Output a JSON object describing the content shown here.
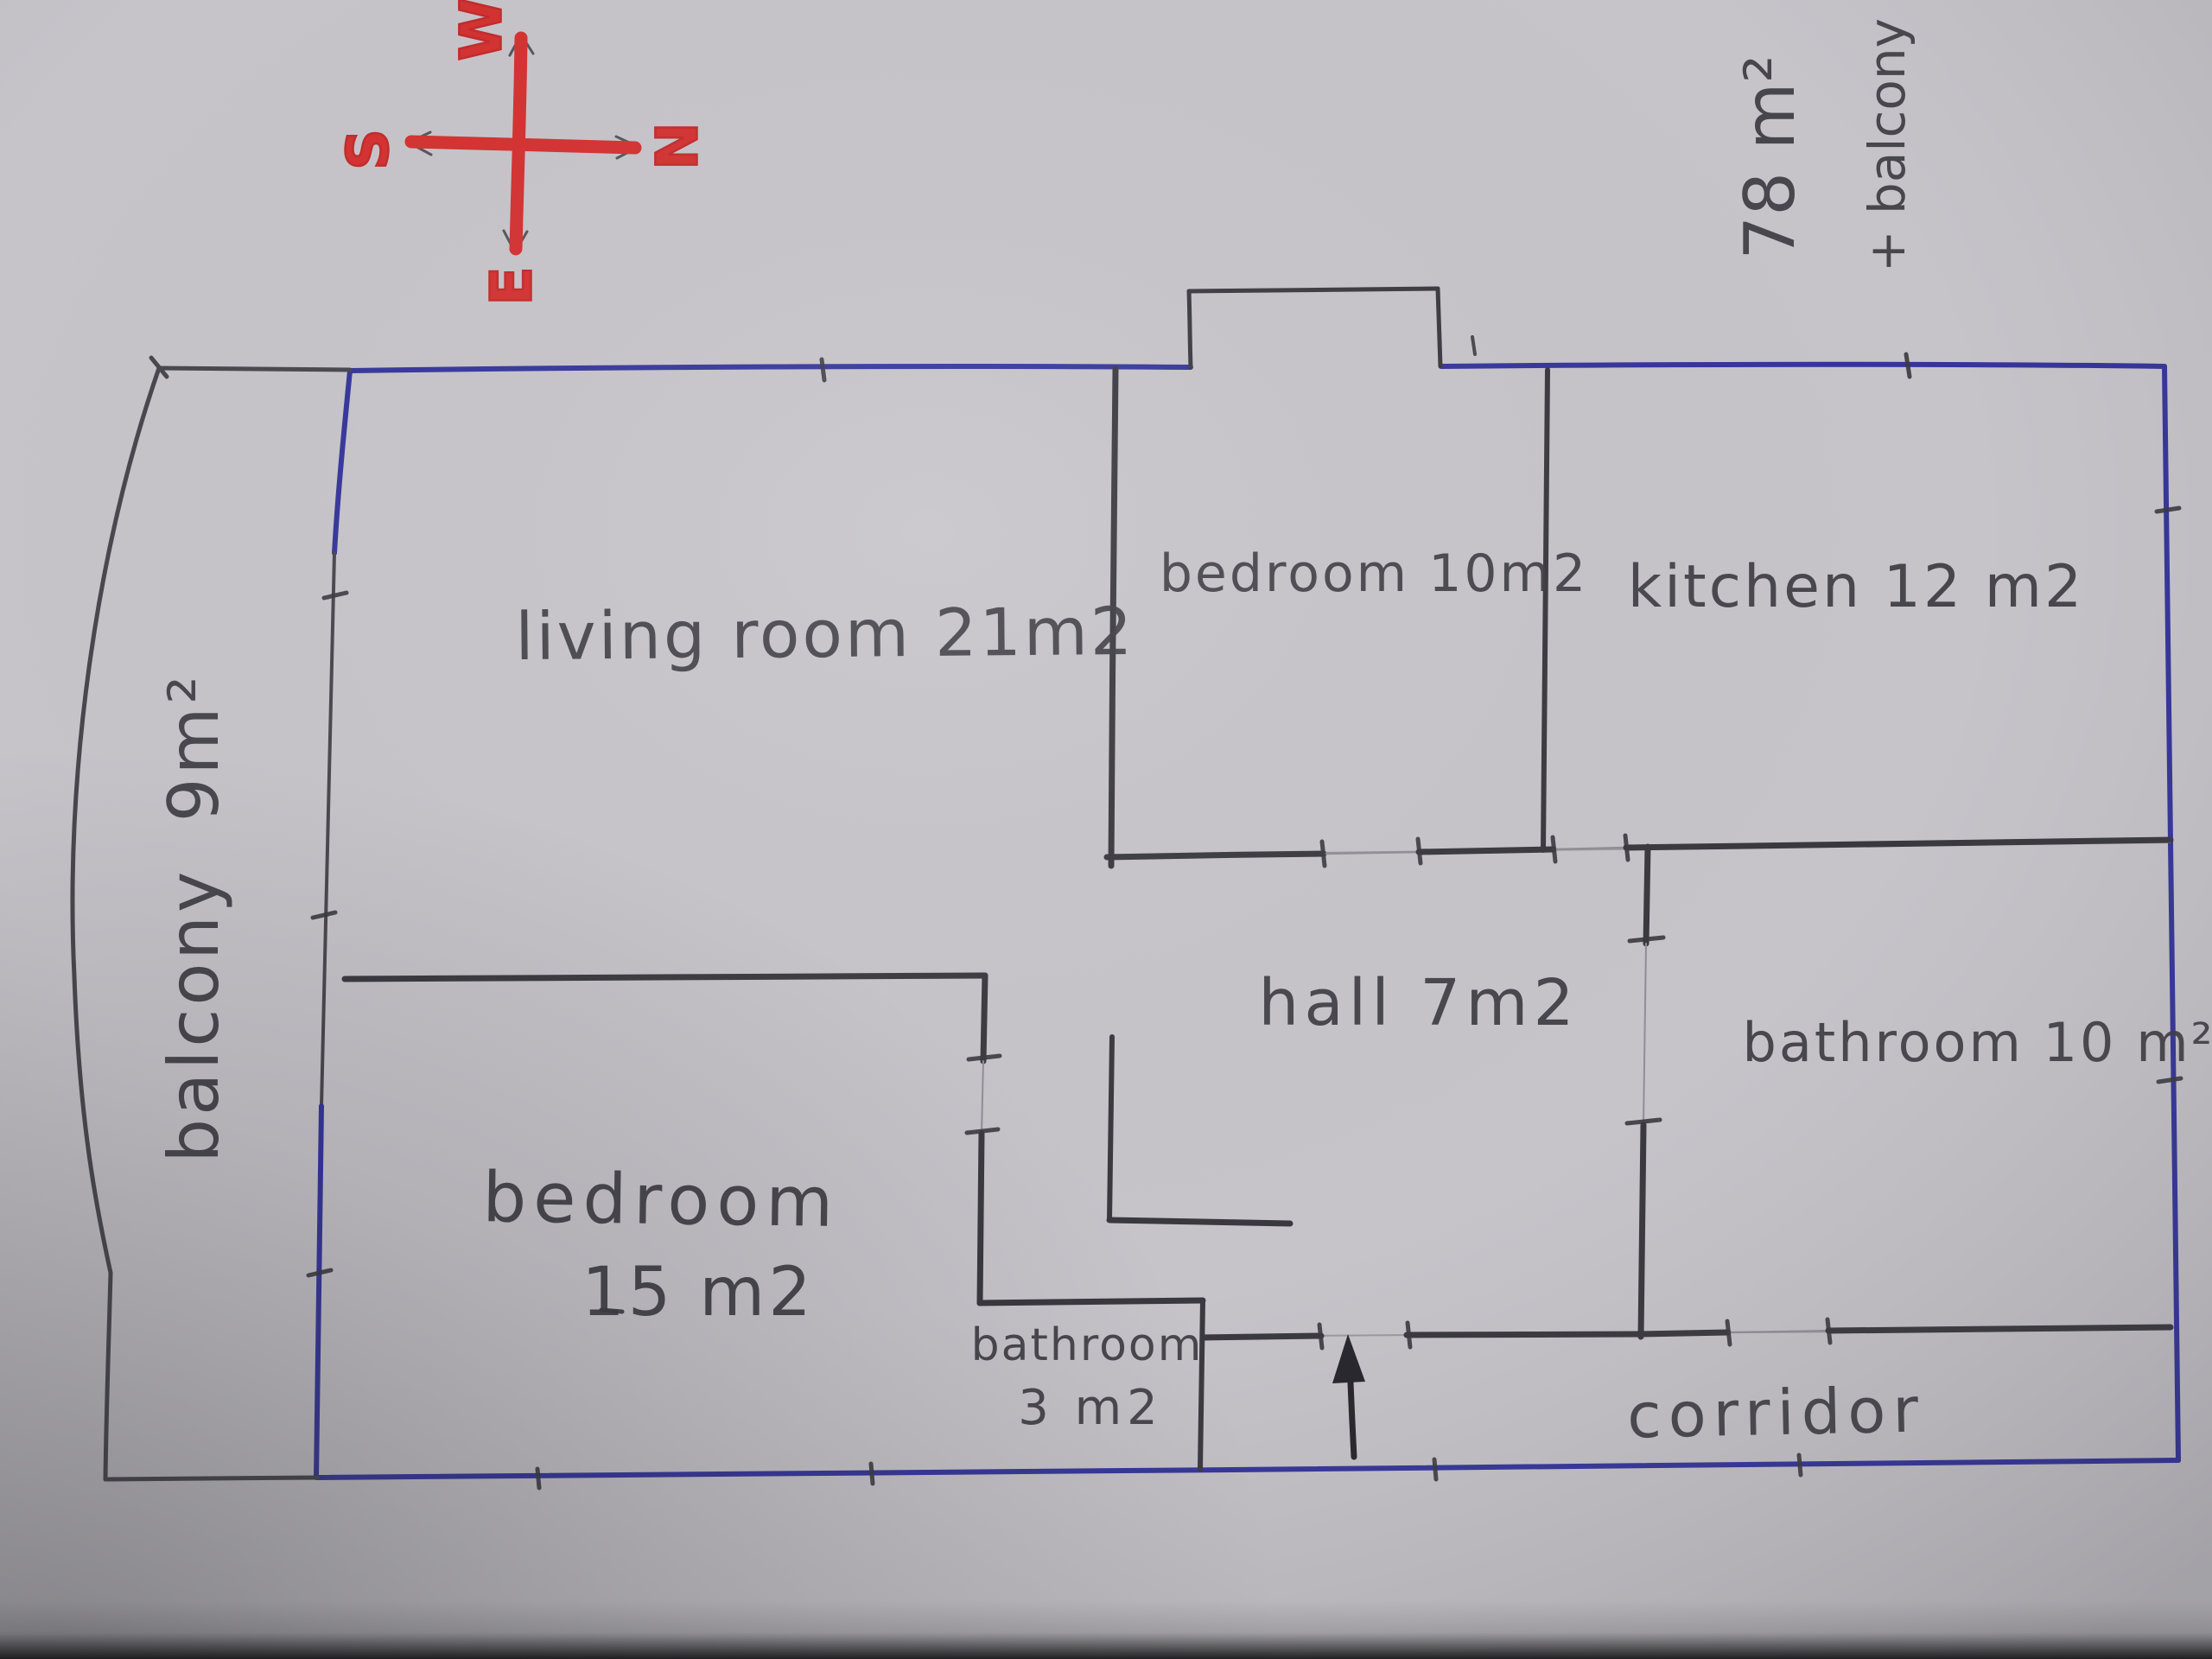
{
  "scene": {
    "description": "hand-drawn apartment floor plan sketch photographed on gray paper"
  },
  "colors": {
    "paper": "#c6c4c9",
    "pencil": "#47464d",
    "ink_blue": "#34349b",
    "marker_red": "#d43030"
  },
  "compass": {
    "north": "N",
    "south": "S",
    "east": "E",
    "west": "W"
  },
  "total_area": {
    "line1": "78 m²",
    "line2": "+ balcony"
  },
  "rooms": {
    "living": {
      "label": "living room 21m2"
    },
    "bedroom10": {
      "label": "bedroom 10m2"
    },
    "kitchen": {
      "label": "kitchen 12 m2"
    },
    "hall": {
      "label": "hall 7m2"
    },
    "bathroom10": {
      "label": "bathroom 10 m²"
    },
    "bedroom15": {
      "name": "bedroom",
      "area": "15 m2"
    },
    "bathroom3": {
      "name": "bathroom",
      "area": "3 m2"
    },
    "corridor": {
      "label": "corridor"
    },
    "balcony": {
      "label": "balcony 9m²"
    }
  }
}
